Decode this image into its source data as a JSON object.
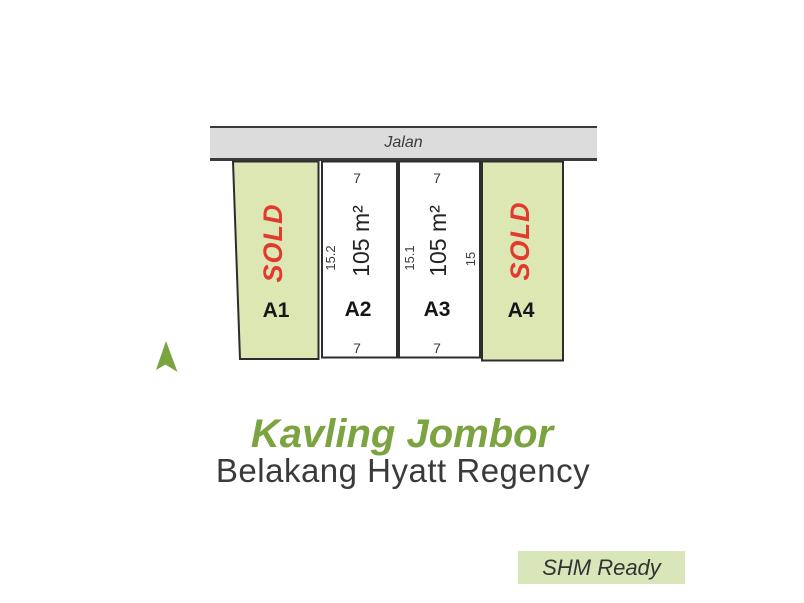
{
  "colors": {
    "accent_green": "#7ba33f",
    "plot_fill": "#dde7b4",
    "plot_border": "#2d2d2d",
    "road_fill": "#dcdcdc",
    "line_dark": "#3b3b3b",
    "sold_red": "#e23a2e",
    "text_dark": "#3a3a3a",
    "badge_bg": "#d9e6ba"
  },
  "road": {
    "label": "Jalan"
  },
  "plots": [
    {
      "id": "A1",
      "status": "SOLD"
    },
    {
      "id": "A2",
      "area": "105 m²",
      "frontage_top": "7",
      "frontage_bottom": "7",
      "depth": "15.2"
    },
    {
      "id": "A3",
      "area": "105 m²",
      "frontage_top": "7",
      "frontage_bottom": "7",
      "depth": "15.1"
    },
    {
      "id": "A4",
      "status": "SOLD",
      "depth": "15"
    }
  ],
  "title": {
    "text": "Kavling Jombor"
  },
  "subtitle": {
    "text": "Belakang Hyatt Regency"
  },
  "badge": {
    "label": "SHM Ready"
  }
}
